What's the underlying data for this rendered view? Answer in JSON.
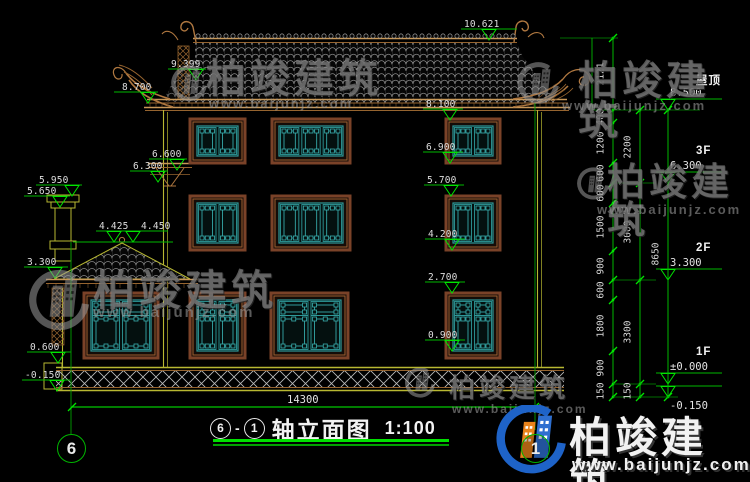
{
  "title_block": {
    "axis_start": "6",
    "dash": "-",
    "axis_end": "1",
    "name": "轴立面图",
    "scale": "1:100"
  },
  "axis_bubbles": [
    {
      "label": "6"
    },
    {
      "label": "1"
    }
  ],
  "overall_dimension": "14300",
  "floor_markers_right": [
    {
      "name": "屋顶",
      "elev": "8.500",
      "L": 110
    },
    {
      "name": "3F",
      "elev": "6.300",
      "L": 183
    },
    {
      "name": "2F",
      "elev": "3.300",
      "L": 280
    },
    {
      "name": "1F",
      "elev": "±0.000",
      "L": 384
    },
    {
      "name": "",
      "elev": "-0.150",
      "L": 397,
      "below": true
    }
  ],
  "elevation_markers_left": [
    {
      "t": "9.399",
      "tx": 171,
      "L": 80,
      "lx": 168,
      "lw": 38,
      "ax": 196
    },
    {
      "t": "8.700",
      "tx": 122,
      "L": 103,
      "lx": 114,
      "lw": 44,
      "ax": 148
    },
    {
      "t": "6.600",
      "tx": 152,
      "L": 170,
      "lx": 149,
      "lw": 38,
      "ax": 177
    },
    {
      "t": "6.300",
      "tx": 133,
      "L": 182,
      "lx": 130,
      "lw": 38,
      "ax": 158
    },
    {
      "t": "5.950",
      "tx": 39,
      "L": 196,
      "lx": 36,
      "lw": 46,
      "ax": 72
    },
    {
      "t": "5.650",
      "tx": 27,
      "L": 207,
      "lx": 24,
      "lw": 46,
      "ax": 60
    },
    {
      "t": "4.425",
      "tx": 99,
      "L": 242,
      "lx": 96,
      "lw": 38,
      "ax": 114
    },
    {
      "t": "4.450",
      "tx": 141,
      "L": 242,
      "lx": 124,
      "lw": 44,
      "ax": 133
    },
    {
      "t": "3.300",
      "tx": 27,
      "L": 278,
      "lx": 24,
      "lw": 44,
      "ax": 55
    },
    {
      "t": "0.600",
      "tx": 30,
      "L": 363,
      "lx": 27,
      "lw": 44,
      "ax": 58
    },
    {
      "t": "-0.150",
      "tx": 25,
      "L": 391,
      "lx": 22,
      "lw": 48,
      "ax": 57
    }
  ],
  "elevation_markers_mid": [
    {
      "t": "8.100",
      "tx": 426,
      "L": 120,
      "lx": 423,
      "lw": 40,
      "ax": 450
    },
    {
      "t": "6.900",
      "tx": 426,
      "L": 163,
      "lx": 423,
      "lw": 40,
      "ax": 450
    },
    {
      "t": "5.700",
      "tx": 427,
      "L": 196,
      "lx": 424,
      "lw": 40,
      "ax": 451
    },
    {
      "t": "4.200",
      "tx": 428,
      "L": 250,
      "lx": 425,
      "lw": 40,
      "ax": 452
    },
    {
      "t": "2.700",
      "tx": 428,
      "L": 293,
      "lx": 425,
      "lw": 40,
      "ax": 452
    },
    {
      "t": "0.900",
      "tx": 428,
      "L": 351,
      "lx": 425,
      "lw": 40,
      "ax": 452
    }
  ],
  "marker_top": {
    "t": "10.621",
    "tx": 464,
    "L": 40,
    "lx": 461,
    "lw": 56,
    "ax": 489
  },
  "dimension_chains": [
    {
      "x": 613,
      "ticks": [
        38,
        110,
        123,
        163,
        183,
        203,
        251,
        280,
        300,
        351,
        384,
        397
      ],
      "labels": [
        "2121",
        "400",
        "1200",
        "600",
        "600",
        "1500",
        "900",
        "600",
        "1800",
        "900",
        "150"
      ]
    },
    {
      "x": 640,
      "ticks": [
        110,
        183,
        280,
        384,
        397
      ],
      "labels": [
        "2200",
        "3000",
        "3300",
        "150"
      ]
    },
    {
      "x": 668,
      "ticks": [
        110,
        397
      ],
      "labels": [
        "8650"
      ]
    }
  ],
  "connectors": [
    {
      "y": 38,
      "x1": 560,
      "x2": 618
    },
    {
      "y": 110,
      "x1": 592,
      "x2": 700
    },
    {
      "y": 183,
      "x1": 613,
      "x2": 656
    },
    {
      "y": 280,
      "x1": 613,
      "x2": 656
    },
    {
      "y": 384,
      "x1": 613,
      "x2": 656
    },
    {
      "y": 397,
      "x1": 613,
      "x2": 678
    }
  ],
  "watermark": {
    "text": "柏竣建筑",
    "url": "www.baijunjz.com",
    "instances": [
      {
        "variant": "gray",
        "lx": 170,
        "ly": 57,
        "lw": 38,
        "lh": 56,
        "tx": 206,
        "ty": 59,
        "ts": 40,
        "ux": 209,
        "uy": 97,
        "us": 13
      },
      {
        "variant": "gray",
        "lx": 516,
        "ly": 59,
        "lw": 44,
        "lh": 52,
        "tx": 578,
        "ty": 61,
        "ts": 40,
        "ux": 562,
        "uy": 99,
        "us": 13
      },
      {
        "variant": "gray",
        "lx": 576,
        "ly": 160,
        "lw": 34,
        "lh": 50,
        "tx": 607,
        "ty": 164,
        "ts": 38,
        "ux": 597,
        "uy": 203,
        "us": 13
      },
      {
        "variant": "gray",
        "lx": 27,
        "ly": 263,
        "lw": 64,
        "lh": 80,
        "tx": 93,
        "ty": 270,
        "ts": 42,
        "ux": 93,
        "uy": 305,
        "us": 15
      },
      {
        "variant": "gray",
        "lx": 394,
        "ly": 368,
        "lw": 52,
        "lh": 32,
        "tx": 449,
        "ty": 375,
        "ts": 26,
        "ux": 452,
        "uy": 403,
        "us": 12
      },
      {
        "variant": "color",
        "lx": 494,
        "ly": 405,
        "lw": 74,
        "lh": 74,
        "tx": 569,
        "ty": 417,
        "ts": 42,
        "ux": 572,
        "uy": 456,
        "us": 17
      }
    ]
  }
}
